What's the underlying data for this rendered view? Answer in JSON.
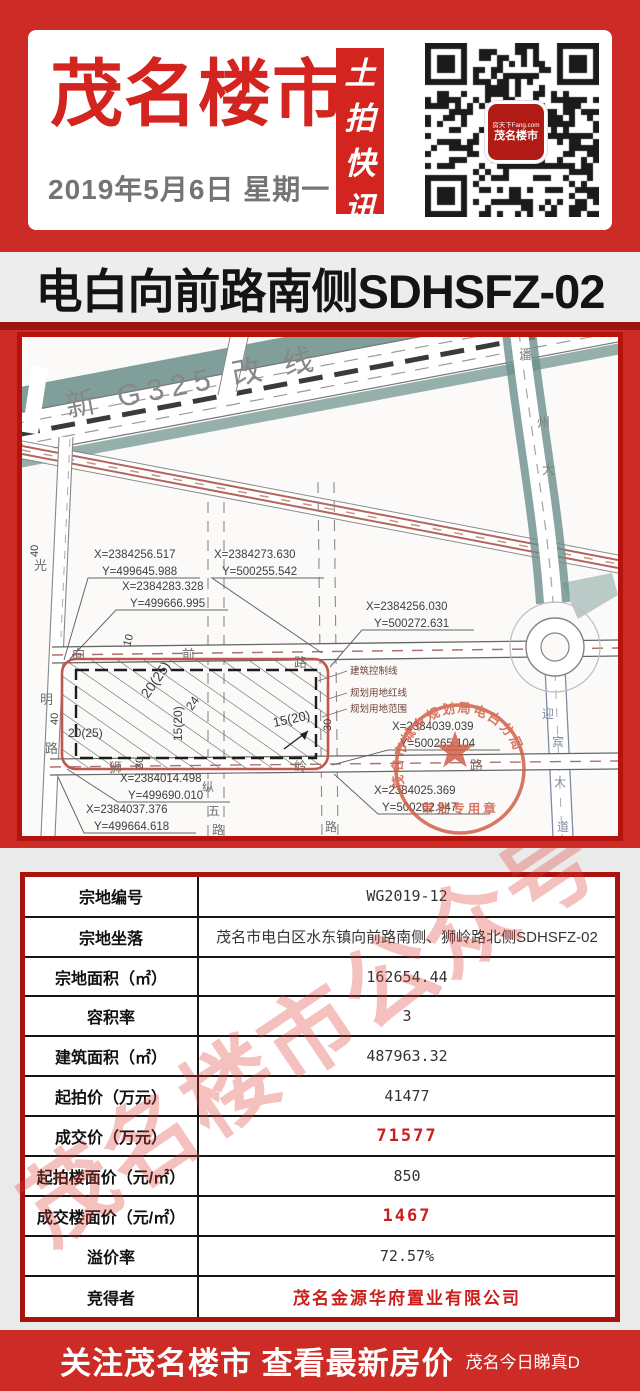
{
  "header": {
    "brand": "茂名楼市",
    "date": "2019年5月6日 星期一",
    "banner_vertical": [
      "土",
      "拍",
      "快",
      "讯"
    ],
    "qr": {
      "logo_line1": "房天下Fang.com",
      "logo_line2": "茂名楼市"
    }
  },
  "title_bar": {
    "text": "电白向前路南侧SDHSFZ-02"
  },
  "map": {
    "g325_label": "新  G325  改 线",
    "coords": [
      {
        "x": "X=2384256.517",
        "y": "Y=499645.988"
      },
      {
        "x": "X=2384273.630",
        "y": "Y=500255.542"
      },
      {
        "x": "X=2384283.328",
        "y": "Y=499666.995"
      },
      {
        "x": "X=2384256.030",
        "y": "Y=500272.631"
      },
      {
        "x": "X=2384039.039",
        "y": "Y=500265.104"
      },
      {
        "x": "X=2384014.498",
        "y": "Y=499690.010"
      },
      {
        "x": "X=2384037.376",
        "y": "Y=499664.618"
      },
      {
        "x": "X=2384025.369",
        "y": "Y=500262.947"
      }
    ],
    "legend": [
      "建筑控制线",
      "规划用地红线",
      "规划用地范围"
    ],
    "dims": [
      "20(25)",
      "24",
      "15(20)",
      "15(20)",
      "20(25)",
      "30",
      "30",
      "10",
      "40",
      "40"
    ],
    "roads": {
      "xiangqian": [
        "向",
        "前",
        "路"
      ],
      "shiling": [
        "狮",
        "岭",
        "路"
      ],
      "guangming": [
        "光",
        "明",
        "路"
      ],
      "zongwu": [
        "纵",
        "五",
        "路"
      ],
      "lu2": "路",
      "panzhou": [
        "潘",
        "州",
        "大"
      ],
      "yingbin": [
        "迎",
        "宾",
        "大",
        "道"
      ]
    },
    "stamp": {
      "top": "茂名市城乡规划局电白分局",
      "bottom": "审批专用章"
    }
  },
  "table": {
    "rows": [
      {
        "label": "宗地编号",
        "value": "WG2019-12"
      },
      {
        "label": "宗地坐落",
        "value": "茂名市电白区水东镇向前路南侧、狮岭路北侧SDHSFZ-02"
      },
      {
        "label": "宗地面积（㎡）",
        "value": "162654.44"
      },
      {
        "label": "容积率",
        "value": "3"
      },
      {
        "label": "建筑面积（㎡）",
        "value": "487963.32"
      },
      {
        "label": "起拍价（万元）",
        "value": "41477"
      },
      {
        "label": "成交价（万元）",
        "value": "71577"
      },
      {
        "label": "起拍楼面价（元/㎡）",
        "value": "850"
      },
      {
        "label": "成交楼面价（元/㎡）",
        "value": "1467"
      },
      {
        "label": "溢价率",
        "value": "72.57%"
      },
      {
        "label": "竞得者",
        "value": "茂名金源华府置业有限公司"
      }
    ]
  },
  "watermark": {
    "table": "茂名楼市公众号"
  },
  "footer": {
    "main": "关注茂名楼市 查看最新房价",
    "sub": "茂名今日睇真D"
  }
}
